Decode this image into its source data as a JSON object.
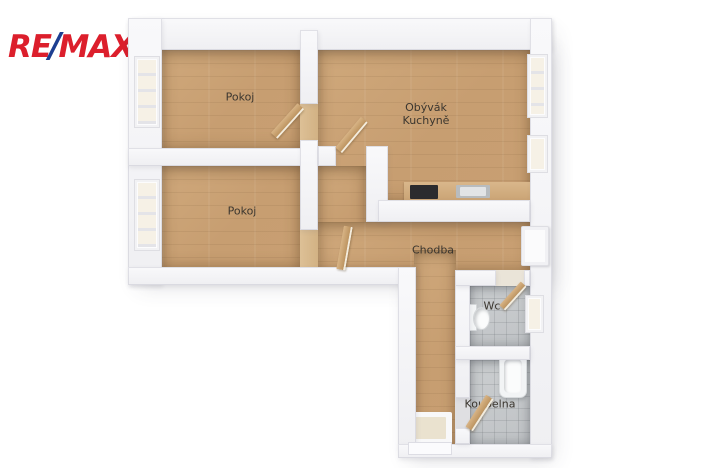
{
  "logo": {
    "re": "RE",
    "slash": "/",
    "max": "MAX"
  },
  "floorplan": {
    "rooms": {
      "pokoj1": {
        "label": "Pokoj"
      },
      "pokoj2": {
        "label": "Pokoj"
      },
      "obyvak": {
        "label_line1": "Obývák",
        "label_line2": "Kuchyně"
      },
      "chodba": {
        "label": "Chodba"
      },
      "wc": {
        "label": "Wc"
      },
      "koupelna": {
        "label": "Koupelna"
      }
    }
  },
  "colors": {
    "brand_red": "#DC1F2C",
    "brand_blue": "#1C3E91",
    "wood_floor": "#C79E71",
    "tile_floor": "#C0C3C6",
    "wall": "#EFEFF2",
    "door_wood": "#BD9460",
    "label_text": "#3B362F"
  }
}
